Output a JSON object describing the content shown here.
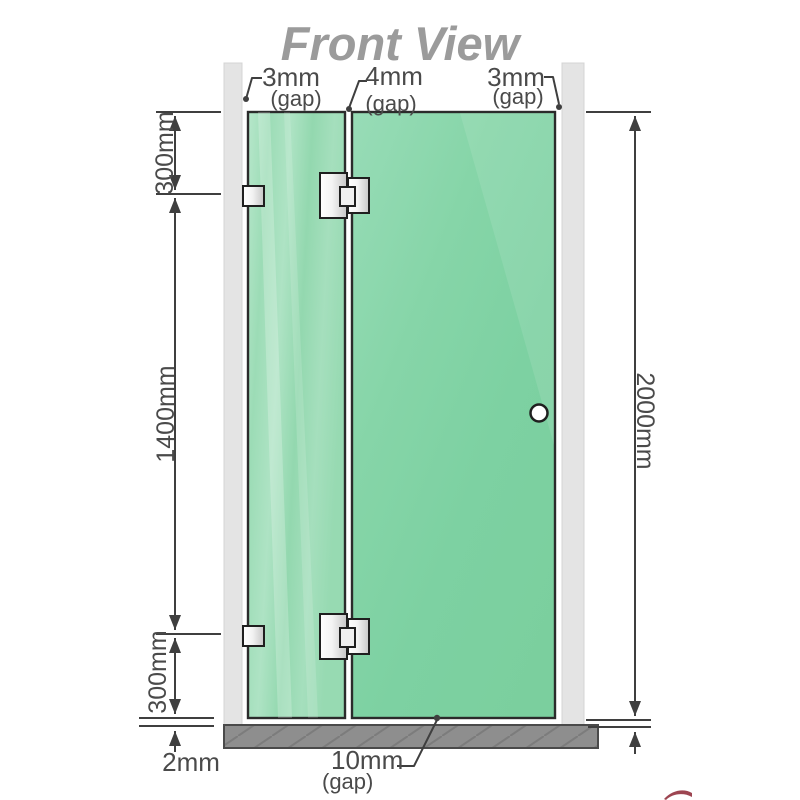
{
  "title": "Front View",
  "labels": {
    "gap_top_left": {
      "value": "3mm",
      "qualifier": "(gap)"
    },
    "gap_top_middle": {
      "value": "4mm",
      "qualifier": "(gap)"
    },
    "gap_top_right": {
      "value": "3mm",
      "qualifier": "(gap)"
    },
    "height_top_section": "300mm",
    "height_middle_section": "1400mm",
    "height_bottom_section": "300mm",
    "gap_floor_left": "2mm",
    "height_total": "2000mm",
    "gap_bottom_center": {
      "value": "10mm",
      "qualifier": "(gap)"
    }
  },
  "colors": {
    "glass_base": "#7ccf9f",
    "glass_light": "#a9e2c1",
    "wall_channel": "#e4e4e4",
    "floor_base": "#8e8e8e",
    "floor_hatch": "#7c7c7c",
    "dimension_line": "#3f3f3f",
    "label_text": "#4a4a4a",
    "title_text": "#9b9b9b",
    "hardware_metal": "#e8e8e8",
    "outline": "#2b2b2b",
    "watermark_red": "#8c2433"
  }
}
